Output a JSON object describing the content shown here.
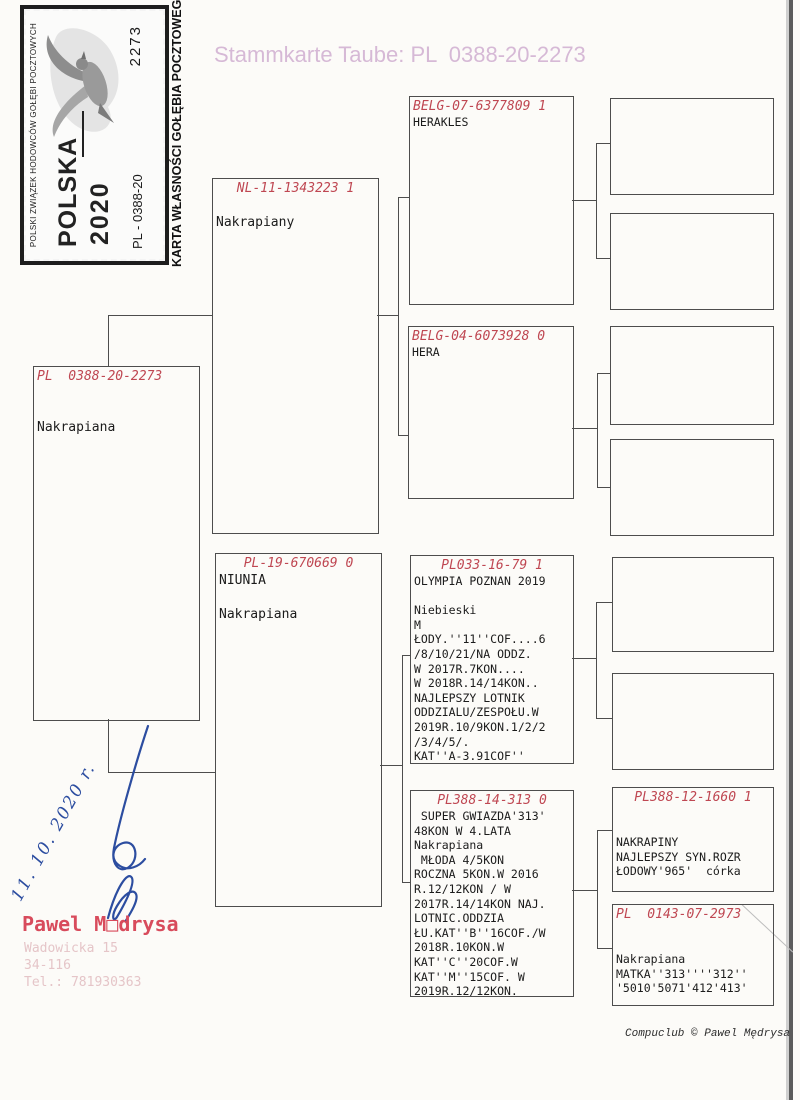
{
  "title": "Stammkarte Taube: PL  0388-20-2273",
  "stamp": {
    "association": "POLSKI ZWIĄZEK HODOWCÓW GOŁĘBI POCZTOWYCH",
    "country": "POLSKA",
    "year": "2020",
    "ring_prefix": "PL - 0388-20",
    "ring_number": "2273",
    "caption": "KARTA WŁASNOŚCI GOŁĘBIA POCZTOWEGO"
  },
  "pedigree": {
    "subject": {
      "ring": "PL  0388-20-2273",
      "details": "\n\nNakrapiana"
    },
    "father": {
      "ring": "NL-11-1343223 1",
      "details": "\nNakrapiany"
    },
    "mother": {
      "ring": "PL-19-670669 0",
      "details": "NIUNIA\n\nNakrapiana"
    },
    "ff": {
      "ring": "BELG-07-6377809 1",
      "details": "HERAKLES"
    },
    "fm": {
      "ring": "BELG-04-6073928 0",
      "details": "HERA"
    },
    "mf": {
      "ring": "PL033-16-79 1",
      "details": "OLYMPIA POZNAN 2019\n\nNiebieski\nM\nŁODY.''11''COF....6\n/8/10/21/NA ODDZ.\nW 2017R.7KON....\nW 2018R.14/14KON..\nNAJLEPSZY LOTNIK\nODDZIALU/ZESPOŁU.W\n2019R.10/9KON.1/2/2\n/3/4/5/.\nKAT''A-3.91COF''"
    },
    "mm": {
      "ring": "PL388-14-313 0",
      "details": " SUPER GWIAZDA'313'\n48KON W 4.LATA\nNakrapiana\n MŁODA 4/5KON\nROCZNA 5KON.W 2016\nR.12/12KON / W\n2017R.14/14KON NAJ.\nLOTNIC.ODDZIA\nŁU.KAT''B''16COF./W\n2018R.10KON.W\nKAT''C''20COF.W\nKAT''M''15COF. W\n2019R.12/12KON."
    },
    "mmf": {
      "ring": "PL388-12-1660 1",
      "details": "\n\nNAKRAPINY\nNAJLEPSZY SYN.ROZR\nŁODOWY'965'  córka"
    },
    "mmm": {
      "ring": "PL  0143-07-2973",
      "details": "\n\nNakrapiana\nMATKA''313''''312''\n'5010'5071'412'413'"
    }
  },
  "handwriting": {
    "date": "11. 10. 2020 r."
  },
  "owner": {
    "name": "Pawel M□drysa",
    "street": "Wadowicka 15",
    "postal": "34-116",
    "phone": "Tel.: 781930363"
  },
  "footer": {
    "credit": "Compuclub © Pawel Mędrysa"
  },
  "colors": {
    "ring_red": "#bf4752",
    "title_pink": "#d6b9d6",
    "owner_red": "#d84b5c",
    "ink_blue": "#2c4da0"
  }
}
